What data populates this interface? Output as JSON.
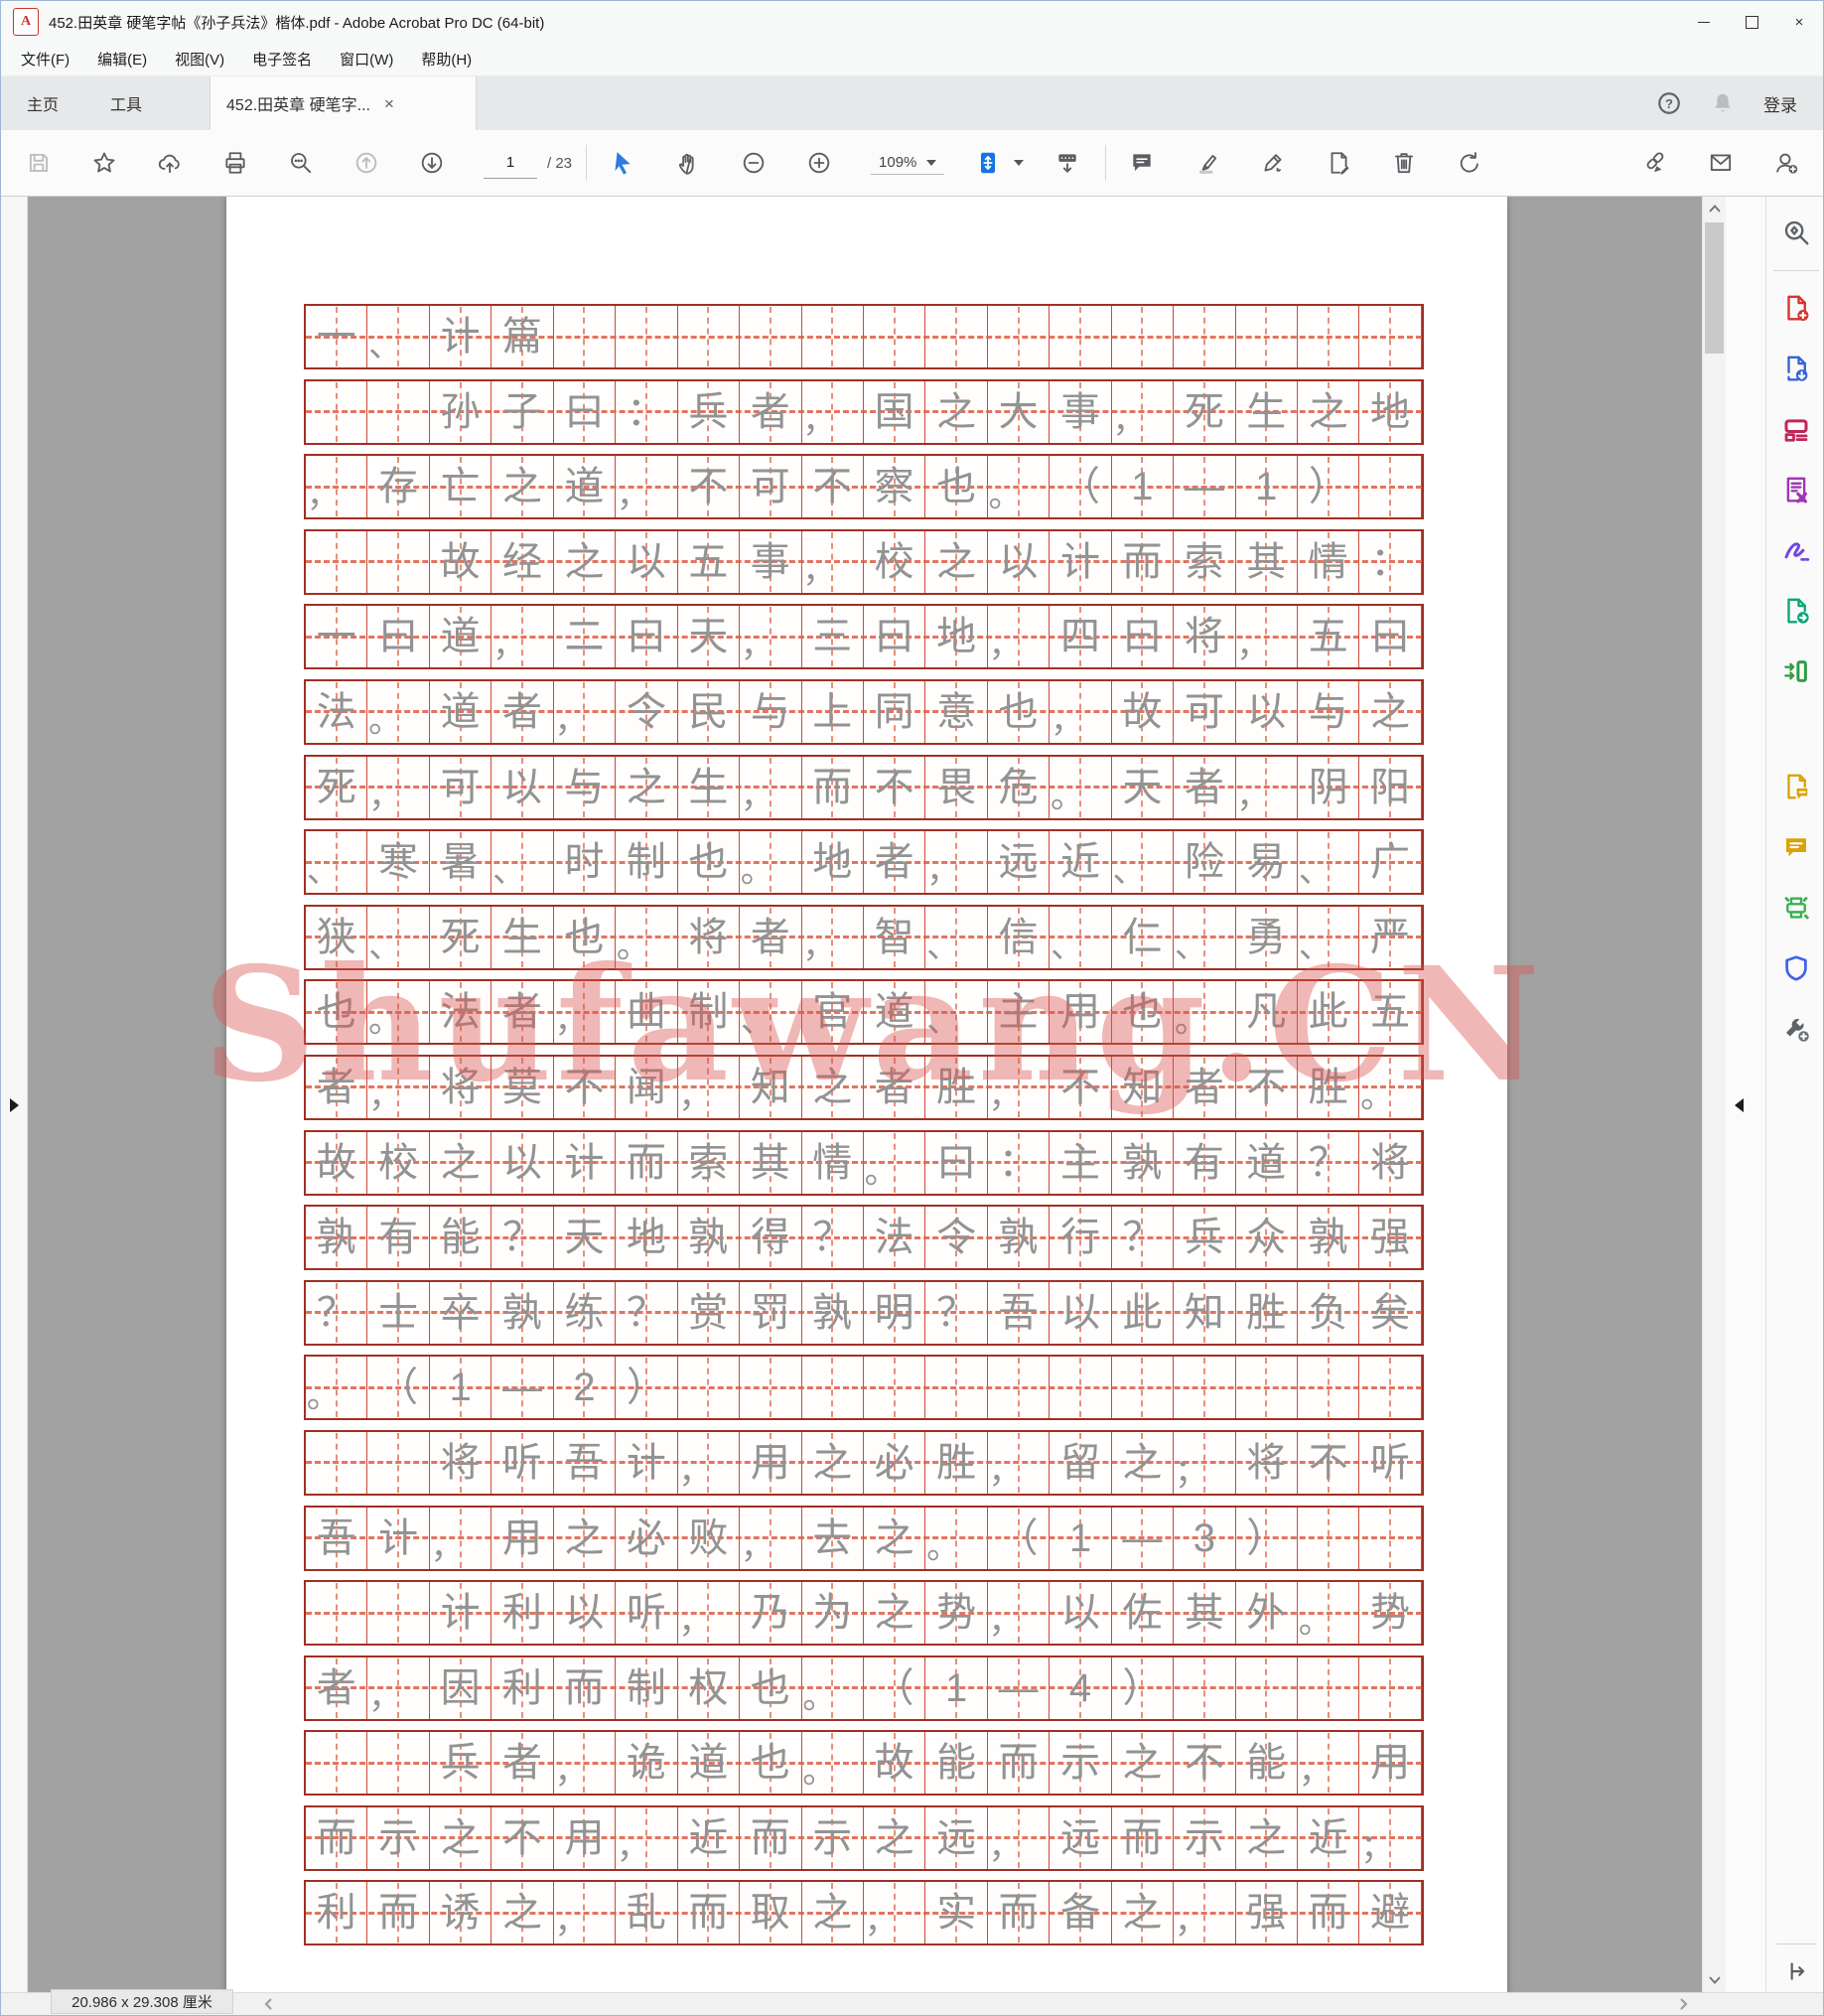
{
  "window": {
    "title": "452.田英章 硬笔字帖《孙子兵法》楷体.pdf - Adobe Acrobat Pro DC (64-bit)"
  },
  "menu": {
    "items": [
      "文件(F)",
      "编辑(E)",
      "视图(V)",
      "电子签名",
      "窗口(W)",
      "帮助(H)"
    ]
  },
  "tab_bar": {
    "home": "主页",
    "tools": "工具",
    "document_tab": "452.田英章 硬笔字...",
    "sign_in": "登录"
  },
  "toolbar": {
    "page_current": "1",
    "page_total_label": "/ 23",
    "zoom_level": "109%"
  },
  "status_bar": {
    "page_size": "20.986 x 29.308 厘米"
  },
  "watermark": {
    "text": "Shufawang.CN",
    "color": "#d85550"
  },
  "grid": {
    "columns": 18,
    "rows": [
      "一、计篇",
      "  孙子曰：兵者，国之大事，死生之地",
      "，存亡之道，不可不察也。（1—1）",
      "  故经之以五事，校之以计而索其情：",
      "一曰道，二曰天，三曰地，四曰将，五曰",
      "法。道者，令民与上同意也，故可以与之",
      "死，可以与之生，而不畏危。天者，阴阳",
      "、寒暑、时制也。地者，远近、险易、广",
      "狭、死生也。将者，智、信、仁、勇、严",
      "也。法者，曲制、官道、主用也。凡此五",
      "者，将莫不闻，知之者胜，不知者不胜。",
      "故校之以计而索其情。曰：主孰有道？将",
      "孰有能？天地孰得？法令孰行？兵众孰强",
      "？士卒孰练？赏罚孰明？吾以此知胜负矣",
      "。（1—2）",
      "  将听吾计，用之必胜，留之；将不听",
      "吾计，用之必败，去之。（1—3）",
      "  计利以听，乃为之势，以佐其外。势",
      "者，因利而制权也。（1—4）",
      "  兵者，诡道也。故能而示之不能，用",
      "而示之不用，近而示之远，远而示之近；",
      "利而诱之，乱而取之，实而备之，强而避"
    ]
  },
  "tools_panel": {
    "tools": [
      {
        "name": "search-tools",
        "color": "#5f6368"
      },
      {
        "name": "create-pdf",
        "color": "#d6342c"
      },
      {
        "name": "export-pdf",
        "color": "#3662d8"
      },
      {
        "name": "edit-pdf",
        "color": "#c2255c"
      },
      {
        "name": "request-signatures",
        "color": "#9c36b5"
      },
      {
        "name": "fill-sign",
        "color": "#7048e8"
      },
      {
        "name": "send-file",
        "color": "#0ca678"
      },
      {
        "name": "combine-files",
        "color": "#2f9e44"
      },
      {
        "name": "send-for-comments",
        "color": "#d9a406"
      },
      {
        "name": "comments",
        "color": "#d9a406"
      },
      {
        "name": "scan-ocr",
        "color": "#37b24d"
      },
      {
        "name": "protect",
        "color": "#4263eb"
      },
      {
        "name": "more-tools",
        "color": "#5f6368"
      }
    ]
  }
}
